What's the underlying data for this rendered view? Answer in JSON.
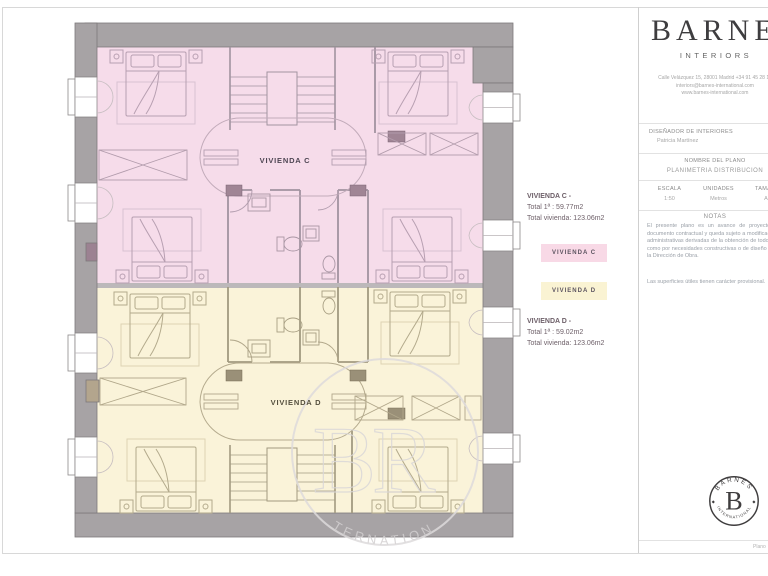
{
  "brand": {
    "name": "BARNES",
    "subtitle": "INTERIORS",
    "address_line1": "Calle Velázquez 15, 28001 Madrid +34 91 45 28 18",
    "address_line2": "interiors@barnes-international.com",
    "address_line3": "www.barnes-international.com"
  },
  "designer": {
    "label": "DISEÑADOR DE INTERIORES",
    "name": "Patricia Martínez"
  },
  "plan_name": {
    "label": "NOMBRE DEL PLANO",
    "value": "PLANIMETRIA DISTRIBUCION"
  },
  "meta": {
    "cols": [
      {
        "label": "ESCALA",
        "value": "1:50"
      },
      {
        "label": "UNIDADES",
        "value": "Metros"
      },
      {
        "label": "TAMAÑO",
        "value": "A3"
      },
      {
        "label": "VERSION",
        "value": "01"
      }
    ]
  },
  "notes": {
    "title": "NOTAS",
    "p1": "El presente plano es un avance de proyecto meramente orientativo, no constituye documento contractual y queda sujeto a modificaciones por exigencias técnicas, jurídicas o administrativas derivadas de la obtención de todos los permisos y licencias reglamentarias, como por necesidades constructivas o de diseño derivadas del desarrollo del proyecto y de la Dirección de Obra.",
    "p2": "Las superficies útiles tienen carácter provisional."
  },
  "legend": {
    "c": {
      "title": "VIVIENDA C -",
      "line1": "Total 1ª : 59.77m2",
      "line2": "Total vivienda: 123.06m2",
      "swatch_label": "VIVIENDA C"
    },
    "d": {
      "title": "VIVIENDA D -",
      "line1": "Total 1ª : 59.02m2",
      "line2": "Total vivienda: 123.06m2",
      "swatch_label": "VIVIENDA D"
    }
  },
  "plan": {
    "label_c": "VIVIENDA C",
    "label_d": "VIVIENDA D"
  },
  "watermark": {
    "monogram": "BR",
    "arc_text": "INTERNATIONAL"
  },
  "seal": {
    "top": "BARNES",
    "letter": "B",
    "bottom": "INTERNATIONAL",
    "diamond": "◆"
  },
  "footer": {
    "page_label": "Plano"
  },
  "colors": {
    "vivienda_c_fill": "#f6dcea",
    "vivienda_d_fill": "#faf3d9",
    "wall_gray": "#a7a3a5",
    "swatch_c": "#f8d9e6",
    "swatch_d": "#faf3d3"
  }
}
